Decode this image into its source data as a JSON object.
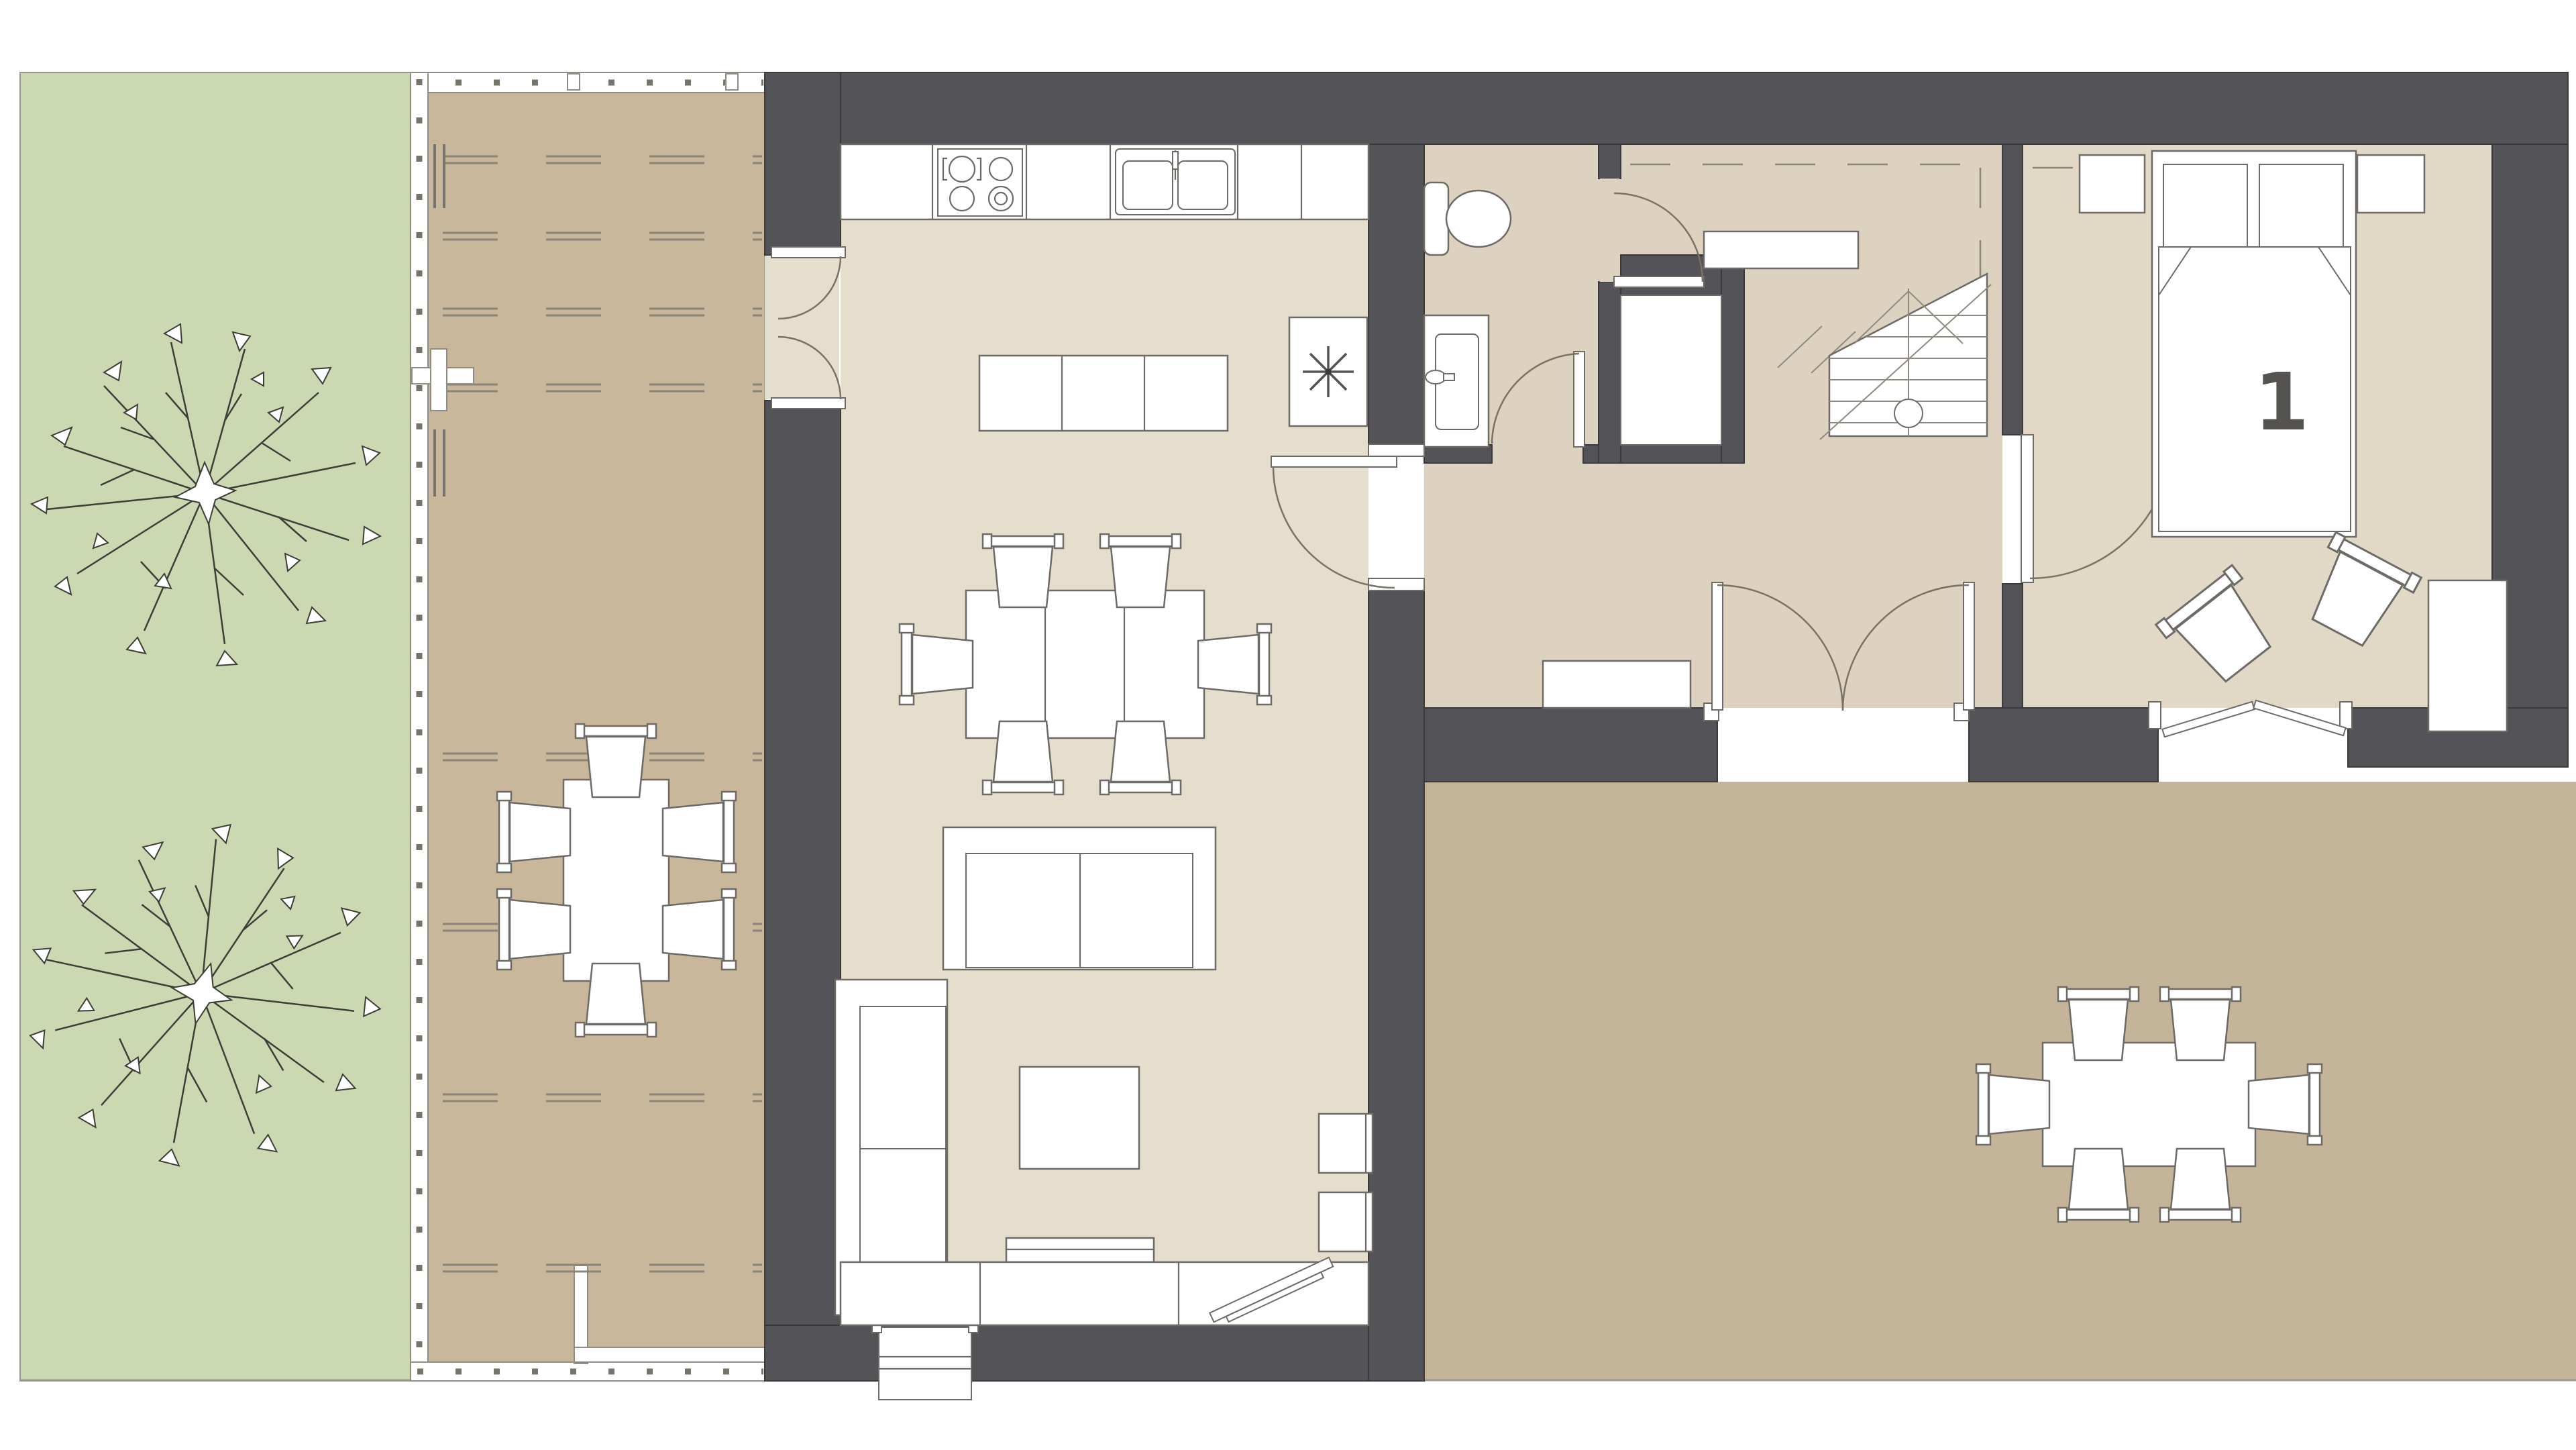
{
  "document": {
    "kind": "architectural floor plan, ground floor, top-down view",
    "visible_text": [
      "1"
    ]
  },
  "rooms": {
    "bedroom_label": "1",
    "inventory": [
      "garden",
      "deck-terrace",
      "kitchen",
      "living-room",
      "bathroom",
      "closet",
      "hallway",
      "staircase",
      "bedroom",
      "rear-terrace"
    ]
  },
  "fixtures": [
    "stove-cooktop",
    "kitchen-sink",
    "kitchen-island",
    "dining-table",
    "dining-chairs",
    "fireplace-stove",
    "sofa",
    "chaise-sofa",
    "coffee-table",
    "side-tables",
    "tv-sideboard",
    "toilet",
    "bathroom-vanity",
    "staircase",
    "hall-sideboard",
    "double-bed",
    "pillows",
    "nightstands",
    "armchairs",
    "wardrobe",
    "outdoor-dining-table",
    "outdoor-chairs",
    "trees",
    "deck-fence",
    "pergola-dashed-lines"
  ],
  "doors": [
    "kitchen-french-doors",
    "living-to-hall-door",
    "bathroom-door",
    "corridor-door",
    "hall-terrace-french-doors",
    "bedroom-door",
    "bedroom-terrace-door",
    "entry-porch"
  ],
  "colors": {
    "wall": "#545357",
    "wall_outline": "#3a393b",
    "floor_living": "#e6decd",
    "floor_hall": "#ddd2bf",
    "floor_bedroom": "#e2d8c6",
    "floor_closet": "#ffffff",
    "terrace": "#c4b49a",
    "deck": "#c9b79c",
    "garden": "#ccd8b2",
    "furniture_fill": "#ffffff",
    "furniture_stroke": "#6e6a66",
    "label": "#55534f",
    "background": "#ffffff"
  }
}
